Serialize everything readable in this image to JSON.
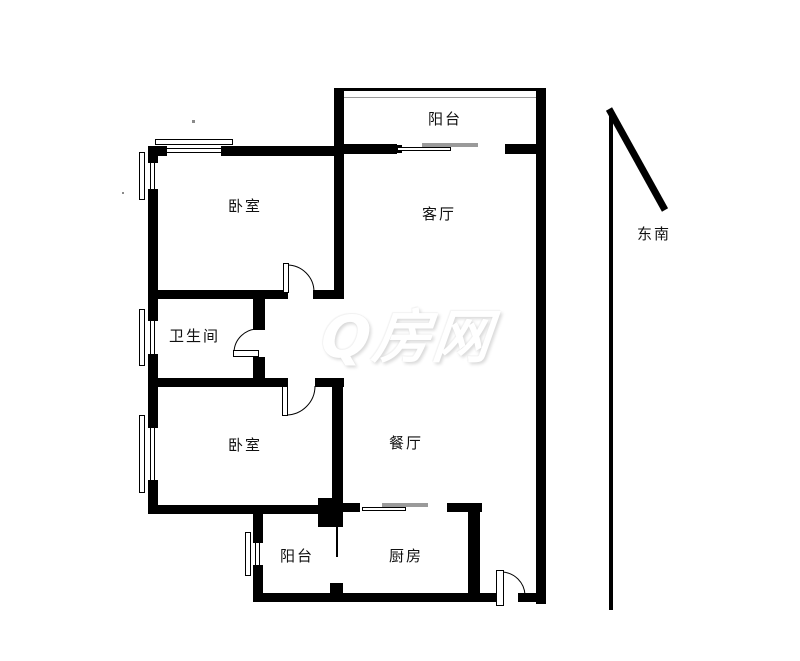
{
  "floorplan": {
    "rooms": {
      "balcony_top": "阳台",
      "bedroom_top": "卧室",
      "living_room": "客厅",
      "bathroom": "卫生间",
      "bedroom_bottom": "卧室",
      "dining_room": "餐厅",
      "balcony_bottom": "阳台",
      "kitchen": "厨房"
    },
    "compass": {
      "label": "东南"
    },
    "watermark": {
      "text": "Q房网"
    },
    "colors": {
      "wall": "#000000",
      "slide_gray": "#9a9a9a",
      "rail_gray": "#9a9a9a",
      "watermark": "#ffffff"
    }
  }
}
